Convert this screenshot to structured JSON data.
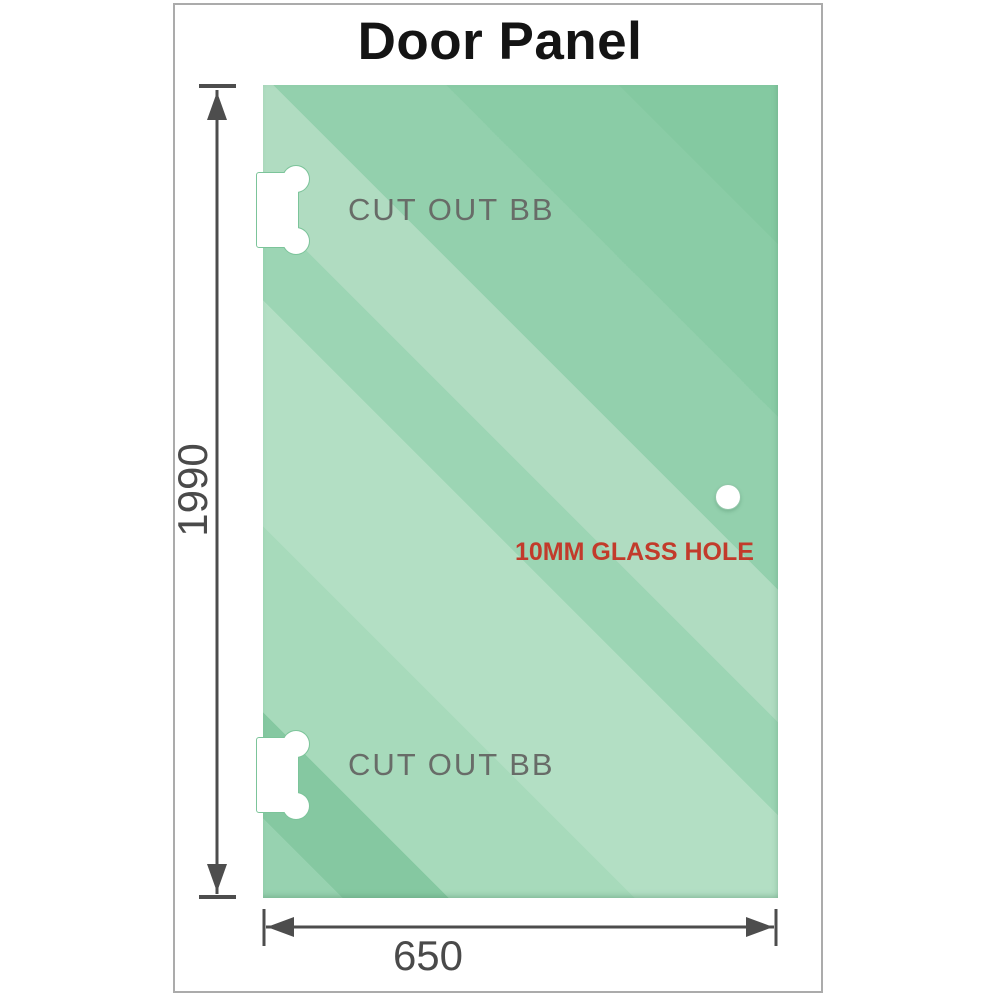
{
  "title": "Door Panel",
  "panel": {
    "cutout_top_label": "CUT OUT BB",
    "cutout_bottom_label": "CUT OUT BB",
    "glass_hole_label": "10MM GLASS HOLE"
  },
  "dimensions": {
    "height_value": "1990",
    "width_value": "650"
  },
  "colors": {
    "glass_base": "#93cfac",
    "glass_light_band": "#b3dfc4",
    "glass_dark_band": "#85c8a1",
    "cutout_outline": "#7cc49a",
    "annotation_red": "#c23b2b",
    "cutout_label_gray": "#686c68",
    "dimension_gray": "#4d4d4d",
    "frame_border": "#ababab",
    "title_color": "#141414"
  }
}
